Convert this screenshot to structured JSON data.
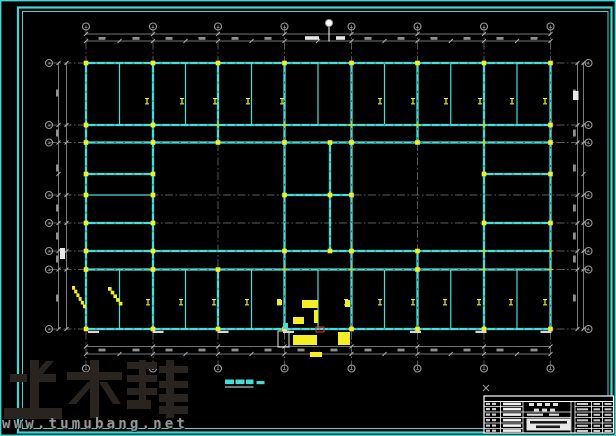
{
  "colors": {
    "cyan": "#48ded8",
    "yellow": "#f3ef25",
    "green": "#b4d832",
    "gray": "#9a9a9a",
    "tick_gray": "#b0b0b0",
    "smudge_gray": "#8f8f8f",
    "white": "#ffffff",
    "red": "#cf2a21",
    "frame_cyan": "#3fd8d4",
    "watermark_dark": "#2a2420",
    "url_gray": "#969696",
    "title_cyan": "#46dcd8"
  },
  "watermark": {
    "brand": "土木帮",
    "url": "www.tumubang.net"
  },
  "plan_title": {
    "text": "平面布置图",
    "scale": "1:100",
    "full": "平面布置图 1:100"
  },
  "drawing": {
    "axes_x": [
      86,
      153,
      218,
      284.5,
      351.5,
      417.5,
      484,
      550.5
    ],
    "mids_x": [
      119.5,
      185.5,
      251.5,
      318,
      384.5,
      450.75,
      517
    ],
    "rows_y": [
      63,
      125,
      142.5,
      195,
      223,
      251,
      269.5,
      329
    ],
    "extra_row_y": 174,
    "white_axis_x": 329,
    "centerline_v_span": [
      27,
      368
    ],
    "centerline_h_span": [
      49,
      588
    ],
    "beams_thick": [
      [
        86,
        63,
        550.5,
        63
      ],
      [
        86,
        125,
        550.5,
        125
      ],
      [
        86,
        142.5,
        550.5,
        142.5
      ],
      [
        86,
        174,
        153,
        174
      ],
      [
        484,
        174,
        550.5,
        174
      ],
      [
        284.5,
        195,
        351.5,
        195
      ],
      [
        86,
        223,
        153,
        223
      ],
      [
        484,
        223,
        550.5,
        223
      ],
      [
        86,
        251,
        550.5,
        251
      ],
      [
        86,
        269.5,
        550.5,
        269.5
      ],
      [
        86,
        329,
        550.5,
        329
      ],
      [
        86,
        63,
        86,
        329
      ],
      [
        153,
        63,
        153,
        329
      ],
      [
        218,
        63,
        218,
        142.5
      ],
      [
        218,
        269.5,
        218,
        329
      ],
      [
        284.5,
        63,
        284.5,
        329
      ],
      [
        330,
        142.5,
        330,
        251
      ],
      [
        351.5,
        63,
        351.5,
        329
      ],
      [
        417.5,
        63,
        417.5,
        142.5
      ],
      [
        417.5,
        251,
        417.5,
        329
      ],
      [
        484,
        63,
        484,
        329
      ],
      [
        550.5,
        63,
        550.5,
        329
      ]
    ],
    "beams_thin": [
      [
        86,
        195,
        153,
        195
      ],
      [
        119.5,
        63,
        119.5,
        125
      ],
      [
        185.5,
        63,
        185.5,
        125
      ],
      [
        251.5,
        63,
        251.5,
        125
      ],
      [
        318,
        63,
        318,
        125
      ],
      [
        384.5,
        63,
        384.5,
        125
      ],
      [
        450.75,
        63,
        450.75,
        125
      ],
      [
        517,
        63,
        517,
        125
      ],
      [
        119.5,
        269.5,
        119.5,
        329
      ],
      [
        185.5,
        269.5,
        185.5,
        329
      ],
      [
        251.5,
        269.5,
        251.5,
        329
      ],
      [
        318,
        269.5,
        318,
        329
      ],
      [
        384.5,
        269.5,
        384.5,
        329
      ],
      [
        450.75,
        269.5,
        450.75,
        329
      ],
      [
        517,
        269.5,
        517,
        329
      ]
    ],
    "columns_yellow": [
      [
        86,
        63
      ],
      [
        153,
        63
      ],
      [
        218,
        63
      ],
      [
        284.5,
        63
      ],
      [
        351.5,
        63
      ],
      [
        417.5,
        63
      ],
      [
        484,
        63
      ],
      [
        550.5,
        63
      ],
      [
        86,
        125
      ],
      [
        153,
        125
      ],
      [
        550.5,
        125
      ],
      [
        86,
        142.5
      ],
      [
        153,
        142.5
      ],
      [
        218,
        142.5
      ],
      [
        284.5,
        142.5
      ],
      [
        330,
        142.5
      ],
      [
        351.5,
        142.5
      ],
      [
        417.5,
        142.5
      ],
      [
        550.5,
        142.5
      ],
      [
        86,
        174
      ],
      [
        153,
        174
      ],
      [
        484,
        174
      ],
      [
        550.5,
        174
      ],
      [
        86,
        195
      ],
      [
        153,
        195
      ],
      [
        284.5,
        195
      ],
      [
        330,
        195
      ],
      [
        351.5,
        195
      ],
      [
        86,
        223
      ],
      [
        153,
        223
      ],
      [
        484,
        223
      ],
      [
        550.5,
        223
      ],
      [
        86,
        251
      ],
      [
        153,
        251
      ],
      [
        284.5,
        251
      ],
      [
        330,
        251
      ],
      [
        351.5,
        251
      ],
      [
        417.5,
        251
      ],
      [
        86,
        269.5
      ],
      [
        153,
        269.5
      ],
      [
        218,
        269.5
      ],
      [
        417.5,
        269.5
      ],
      [
        86,
        329
      ],
      [
        153,
        329
      ],
      [
        218,
        329
      ],
      [
        284.5,
        329
      ],
      [
        351.5,
        329
      ],
      [
        417.5,
        329
      ],
      [
        484,
        329
      ],
      [
        550.5,
        329
      ]
    ],
    "columns_green": [
      [
        218,
        125
      ],
      [
        284.5,
        125
      ],
      [
        351.5,
        125
      ],
      [
        417.5,
        125
      ],
      [
        484,
        125
      ],
      [
        484,
        142.5
      ],
      [
        484,
        251
      ],
      [
        550.5,
        251
      ],
      [
        284.5,
        269.5
      ],
      [
        351.5,
        269.5
      ],
      [
        484,
        269.5
      ],
      [
        550.5,
        269.5
      ]
    ],
    "bay_labels": {
      "top_y": 98,
      "top_x": [
        147,
        182,
        215,
        248,
        282,
        380,
        413,
        446,
        480,
        512,
        545
      ],
      "bottom_y": 299,
      "bottom_x": [
        148,
        181,
        214,
        247,
        279,
        346,
        380,
        413,
        445,
        479,
        511,
        545
      ]
    },
    "dim_lines_h": [
      {
        "y": 34,
        "x1": 86,
        "x2": 550.5,
        "ticks": "axes"
      },
      {
        "y": 41,
        "x1": 86,
        "x2": 550.5,
        "ticks": "both"
      },
      {
        "y": 346.5,
        "x1": 86,
        "x2": 550.5,
        "ticks": "axes"
      },
      {
        "y": 354,
        "x1": 86,
        "x2": 550.5,
        "ticks": "both"
      }
    ],
    "dim_lines_v": [
      {
        "x": 58.5,
        "y1": 63,
        "y2": 329,
        "ticks": "rows174"
      },
      {
        "x": 66.5,
        "y1": 63,
        "y2": 329,
        "ticks": "rows"
      },
      {
        "x": 577.5,
        "y1": 63,
        "y2": 329,
        "ticks": "rows"
      },
      {
        "x": 583.5,
        "y1": 63,
        "y2": 329,
        "ticks": "rows174"
      }
    ],
    "smudges_gray_top": {
      "y": 37,
      "h": 2.8,
      "w": 7,
      "x_centers": [
        102,
        136,
        169,
        202,
        235,
        268,
        368,
        401,
        434,
        467,
        500,
        534
      ]
    },
    "smudges_gray_bottom": {
      "y": 348.6,
      "h": 2.8,
      "w": 7,
      "x_centers": [
        102,
        136,
        169,
        202,
        235,
        268,
        301,
        334,
        368,
        401,
        434,
        467,
        500,
        534
      ]
    },
    "smudges_gray_left": {
      "x": 56,
      "w": 2.8,
      "h": 7,
      "y_centers": [
        93,
        133,
        168,
        208,
        236,
        259,
        298
      ]
    },
    "smudges_gray_right": {
      "x": 573,
      "w": 2.8,
      "h": 7,
      "y_centers": [
        93,
        133,
        168,
        208,
        236,
        259,
        298
      ]
    },
    "smudges_white": [
      [
        305,
        36.2,
        14,
        3.6
      ],
      [
        336,
        36.2,
        9,
        3.6
      ],
      [
        573,
        91,
        5.5,
        9
      ],
      [
        60,
        248,
        5,
        11
      ]
    ],
    "beam_label_marks": {
      "y": 330.8,
      "w": 11,
      "h": 2.2,
      "x": [
        88,
        152.5,
        217.5,
        283,
        410,
        475.5,
        540.5
      ]
    },
    "bubbles": {
      "r": 3.5,
      "top_y": 26.5,
      "bottom_y": 368.5,
      "left_x": 49,
      "right_x": 588.5,
      "white": [
        329,
        23
      ]
    },
    "white_axis_line": [
      329,
      27,
      329,
      41.5
    ],
    "stairs": [
      {
        "x": 72,
        "y": 286,
        "steps": 6,
        "sw": 2.2,
        "sh": 3.7
      },
      {
        "x": 108,
        "y": 287,
        "steps": 5,
        "sw": 2.7,
        "sh": 3.7
      }
    ],
    "detail_rects_yellow": [
      [
        277,
        300,
        5,
        5
      ],
      [
        302,
        300,
        16,
        8
      ],
      [
        345,
        300,
        5,
        7
      ],
      [
        314,
        310,
        4,
        13
      ],
      [
        293,
        317,
        11,
        7
      ],
      [
        293,
        335,
        24,
        10
      ],
      [
        338,
        332,
        12,
        13
      ],
      [
        310,
        352,
        12,
        5
      ]
    ],
    "detail_rect_white": [
      278,
      331,
      11,
      16
    ],
    "detail_rect_red": [
      316,
      327,
      8,
      5
    ],
    "detail_nub_cyan": [
      283,
      323,
      5,
      6
    ],
    "cursor_cross": [
      486,
      388
    ]
  },
  "frame": {
    "edge": [
      0.7,
      0.7,
      614.6,
      434.6
    ],
    "outer": [
      18,
      7.5,
      593.5,
      425
    ],
    "inner": [
      22.5,
      11.5,
      585.5,
      417
    ]
  },
  "plan_title_marks": {
    "smudges": [
      [
        225,
        379.5,
        9,
        4.6
      ],
      [
        235.5,
        379.5,
        9,
        4.6
      ],
      [
        246,
        379.5,
        7.5,
        4.6
      ],
      [
        256.5,
        381,
        8,
        3.2
      ]
    ],
    "underline": [
      225,
      387,
      253.5,
      387
    ]
  },
  "title_block": {
    "x": 484,
    "y": 396,
    "w": 129.5,
    "h": 37,
    "hline_top": 401.5,
    "vlines": [
      500.5,
      523,
      571,
      575,
      591.5,
      602.5
    ],
    "row_lines": [
      406.5,
      412,
      417.5,
      423,
      428.5
    ],
    "left_zone": [
      484,
      523
    ],
    "mid_zone": [
      523,
      571
    ],
    "right_zone": [
      575,
      613.5
    ],
    "white_bars_x": 503,
    "white_bars_w": 18,
    "white_bars_h": 2.6,
    "white_bars_y": [
      402.6,
      407.8,
      413.3,
      418.8,
      424.3,
      429.3
    ],
    "left_pair_ys": [
      402.8,
      408,
      413.5,
      419,
      424.5,
      429.6
    ],
    "mid_header_smudges": [
      [
        529,
        403,
        5,
        3
      ],
      [
        537,
        403,
        5,
        3
      ],
      [
        545,
        403,
        5,
        3
      ],
      [
        553,
        403,
        5,
        3
      ],
      [
        534,
        408.6,
        5,
        2.8
      ],
      [
        542,
        408.6,
        5,
        2.8
      ],
      [
        550,
        408.6,
        5,
        2.8
      ],
      [
        527,
        413.6,
        16,
        2.2
      ],
      [
        549,
        413.6,
        10,
        2.2
      ]
    ],
    "right_cell_ys": [
      403,
      408.3,
      413.8,
      419.3,
      424.8,
      430
    ],
    "white_box": [
      526.5,
      418.5,
      44,
      12
    ],
    "box_smudges": [
      [
        530,
        421,
        37,
        2.6
      ],
      [
        536,
        425.5,
        24,
        2.6
      ]
    ]
  }
}
